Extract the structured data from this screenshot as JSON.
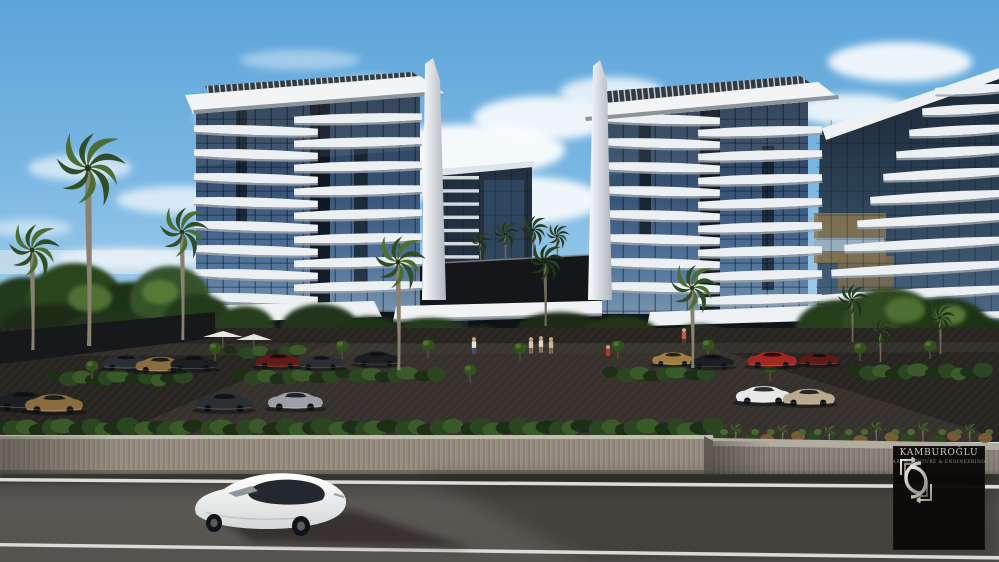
{
  "image": {
    "type": "3d-architectural-rendering",
    "subject": "Twin residential glass towers with white curved balconies, palm trees, landscaped parking lot, perimeter stone wall and street with a passing white sedan",
    "sky": "blue daytime sky with scattered white clouds"
  },
  "branding": {
    "logo_name": "KAMBUROĞLU",
    "logo_subtitle": "ARCHITECTURE & ENGINEERING",
    "logo_monogram_icon": "interlocked-c-brackets-monogram"
  },
  "palette": {
    "sky_top": "#4e9ad3",
    "sky_horizon": "#e8f3fa",
    "glass_dark": "#24364b",
    "glass_light": "#7e9ab2",
    "balcony_white": "#edf0f2",
    "foliage_dark": "#1c2e16",
    "foliage_light": "#4c6e35",
    "plaza_asphalt": "#282521",
    "road_asphalt": "#56534f",
    "wall_stone": "#958d80",
    "lane_line": "#eceae6",
    "sedan_white": "#f0f0ee",
    "plaque_bg": "#0a0908",
    "plaque_text": "#cdc8bf"
  },
  "scene": {
    "tower_left": {
      "floors": 8
    },
    "tower_right": {
      "floors": 8
    },
    "mid_tower": {
      "floors": 10
    },
    "right_building": {
      "balcony_rows": 11
    }
  }
}
